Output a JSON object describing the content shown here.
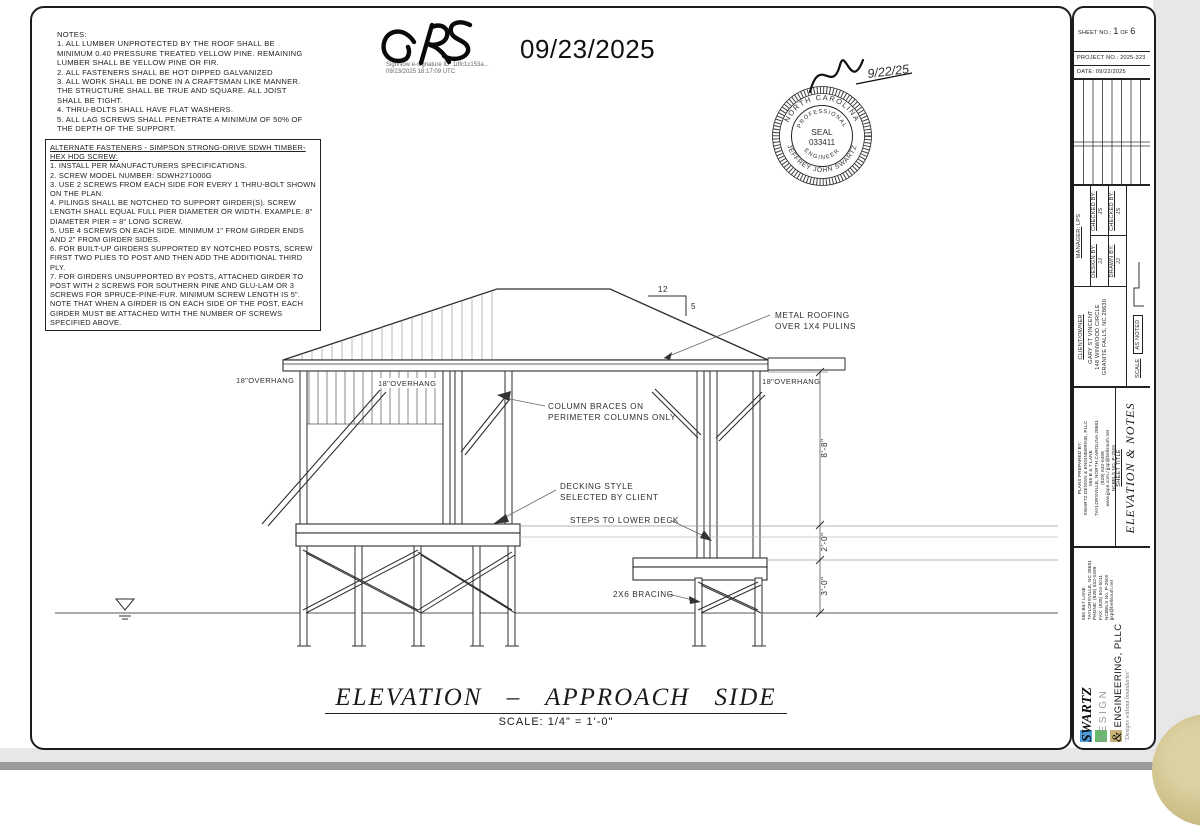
{
  "notes": {
    "title": "NOTES:",
    "items": [
      "1.  ALL LUMBER UNPROTECTED BY THE ROOF SHALL BE MINIMUM 0.40 PRESSURE TREATED YELLOW PINE. REMAINING LUMBER SHALL BE YELLOW PINE OR FIR.",
      "2.  ALL FASTENERS SHALL BE HOT DIPPED GALVANIZED",
      "3.  ALL WORK SHALL BE DONE IN A CRAFTSMAN LIKE MANNER.  THE STRUCTURE SHALL BE TRUE AND SQUARE.  ALL JOIST SHALL BE TIGHT.",
      "4.  THRU-BOLTS SHALL HAVE FLAT WASHERS.",
      "5.  ALL LAG SCREWS SHALL PENETRATE A MINIMUM OF 50% OF THE DEPTH OF THE SUPPORT."
    ]
  },
  "fasteners": {
    "title": "ALTERNATE FASTENERS - SIMPSON STRONG-DRIVE SDWH TIMBER-HEX HDG SCREW:",
    "items": [
      "1.  INSTALL PER MANUFACTURERS SPECIFICATIONS.",
      "2.  SCREW MODEL NUMBER: SDWH271000G",
      "3.  USE 2 SCREWS FROM EACH SIDE FOR EVERY 1 THRU-BOLT SHOWN ON THE PLAN.",
      "4.  PILINGS SHALL BE NOTCHED TO SUPPORT GIRDER(S).  SCREW LENGTH SHALL EQUAL FULL PIER DIAMETER OR WIDTH.  EXAMPLE: 8\" DIAMETER PIER = 8\" LONG SCREW.",
      "5.  USE 4 SCREWS ON EACH SIDE.  MINIMUM 1\" FROM GIRDER ENDS AND 2\" FROM GIRDER SIDES.",
      "6.  FOR BUILT-UP GIRDERS SUPPORTED BY NOTCHED POSTS, SCREW FIRST TWO PLIES TO POST AND THEN ADD THE ADDITIONAL THIRD PLY.",
      "7.  FOR GIRDERS UNSUPPORTED BY POSTS, ATTACHED GIRDER TO POST WITH 2 SCREWS FOR SOUTHERN PINE AND GLU-LAM OR 3 SCREWS FOR SPRUCE-PINE-FUR.  MINIMUM SCREW LENGTH IS 5\". NOTE THAT WHEN A GIRDER IS ON EACH SIDE OF THE POST, EACH GIRDER MUST BE ATTACHED WITH THE NUMBER OF SCREWS SPECIFIED ABOVE."
    ]
  },
  "esign": {
    "initials": "GRS",
    "id_line": "SignNow e-signature ID: 1dfc1c153a...",
    "ts_line": "09/23/2025 18:17:09 UTC",
    "date_large": "09/23/2025"
  },
  "seal": {
    "state": "NORTH CAROLINA",
    "profession": "PROFESSIONAL",
    "word": "SEAL",
    "number": "033411",
    "engineer": "ENGINEER",
    "name": "JEFFREY  JOHN  SWARTZ",
    "handwritten_date": "9/22/25"
  },
  "anno": {
    "pitch_run": "12",
    "pitch_rise": "5",
    "metal1": "METAL ROOFING",
    "metal2": "OVER 1X4 PULINS",
    "overhang": "18\"OVERHANG",
    "braces1": "COLUMN BRACES ON",
    "braces2": "PERIMETER COLUMNS ONLY",
    "decking1": "DECKING STYLE",
    "decking2": "SELECTED BY CLIENT",
    "steps": "STEPS TO LOWER DECK",
    "bracing": "2X6 BRACING",
    "dims": [
      "8'-8\"",
      "2'-0\"",
      "3'-0\""
    ]
  },
  "view": {
    "title": "ELEVATION – APPROACH SIDE",
    "scale": "SCALE: 1/4\" = 1'-0\""
  },
  "titleblock": {
    "sheet_label": "SHEET NO.:",
    "sheet_no": "1",
    "of_label": "OF",
    "sheet_total": "6",
    "project": "PROJECT NO.: 2025-323",
    "date": "DATE: 09/22/2025",
    "manager_label": "MANAGER:",
    "manager": "LPS",
    "design_label": "DESIGN BY:",
    "design": "JJ",
    "drawn_label": "DRAWN BY:",
    "drawn": "JJ",
    "checked_label": "CHECKED BY:",
    "checked": "JS",
    "client_label": "CLIENT/OWNER",
    "client_name": "GARY ST VINCENT",
    "client_addr1": "148 WINWOOD CIRCLE",
    "client_addr2": "GRANITE FALLS, NC 28630",
    "scale_label": "SCALE",
    "scale_value": "AS NOTED",
    "prepared": {
      "lines": [
        "PLANS PREPARED BY:",
        "SWARTZ DESIGN & ENGINEERING, PLLC",
        "565 B & T LANE",
        "TAYLORSVILLE, NORTH CAROLINA 28681",
        "(828) 632-0499",
        "www.jjspe.com / jjsp@bellsouth.net",
        "NCBELS NO. P-2500"
      ]
    },
    "sheet_title_label": "SHEET TITLE",
    "sheet_title": "ELEVATION & NOTES",
    "logo": {
      "swartz": "SWARTZ",
      "design_word": "DESIGN",
      "amp": "&",
      "eng": "ENGINEERING, PLLC",
      "tagline": "\"Designs without boundaries\"",
      "addr": [
        "565 B&T LANE",
        "TAYLORSVILLE, NC 28681",
        "PHONE: (828) 632-0499",
        "FAX: (828) 604-5011",
        "NCBELS No. P-2500",
        "jjsp@bellsouth.net"
      ],
      "blue": "#4f9bd8",
      "green": "#66bb6a",
      "tan": "#c9b178"
    }
  }
}
